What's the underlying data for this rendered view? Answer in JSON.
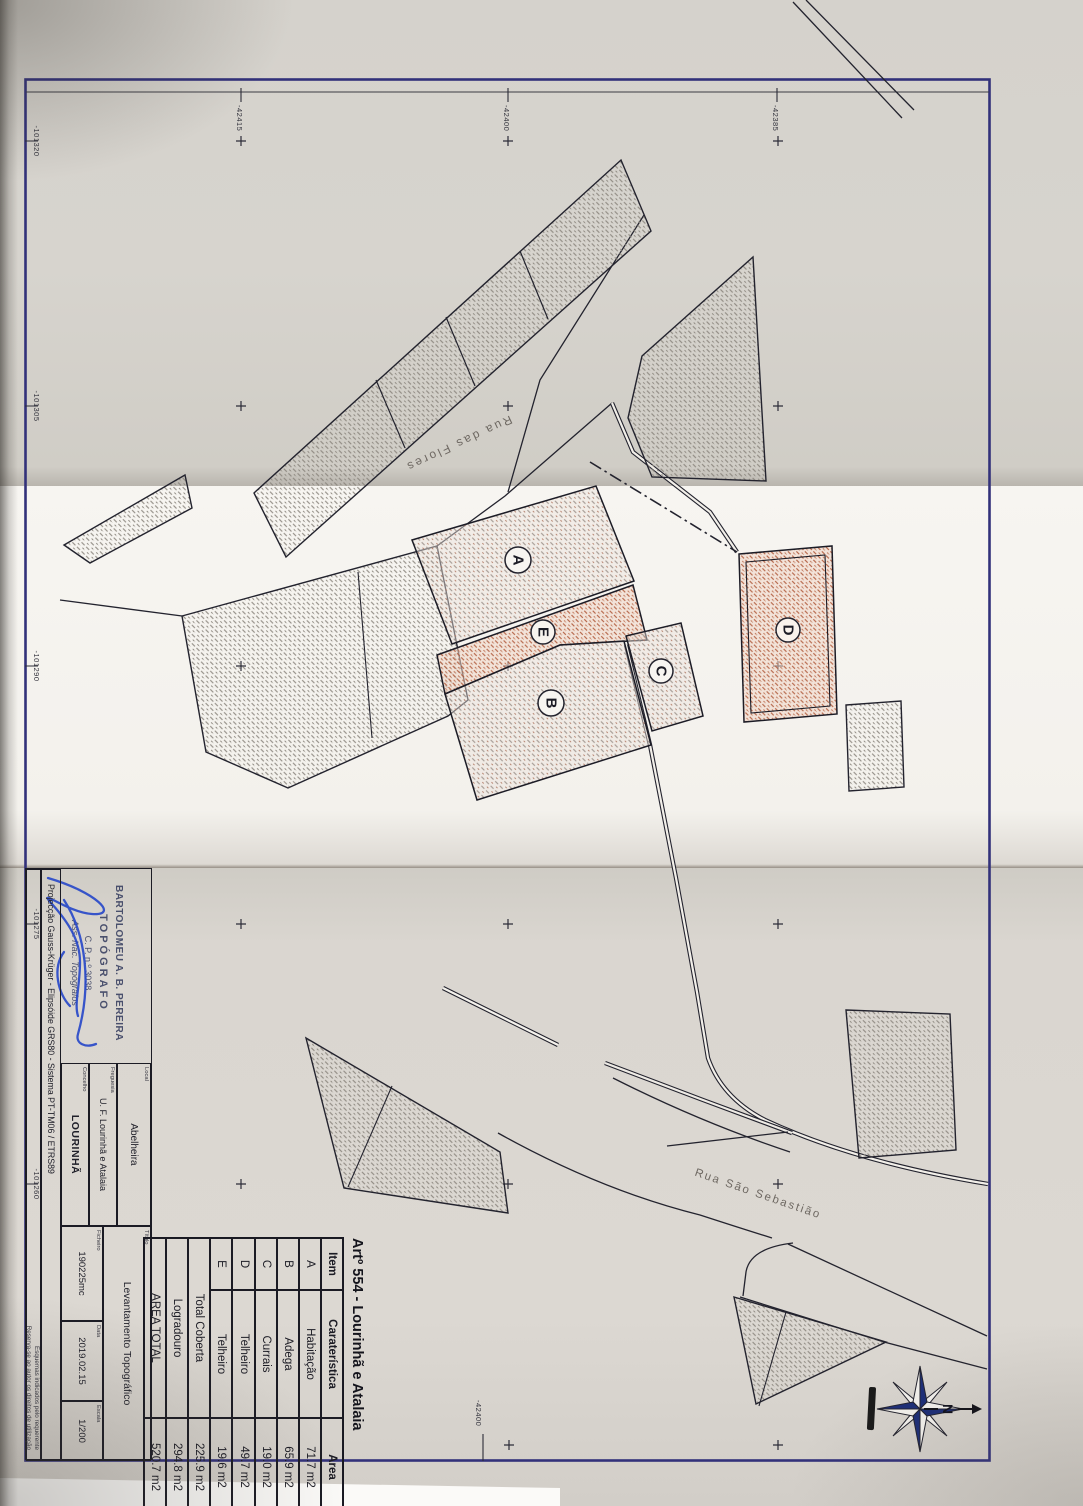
{
  "document": {
    "map_title": "Artº 554 - Lourinhã e Atalaia",
    "scale": "1/200"
  },
  "area_table": {
    "header": {
      "item": "Item",
      "carateristica": "Caraterística",
      "area": "Area"
    },
    "rows": [
      {
        "item": "A",
        "carateristica": "Habitação",
        "area": "71.7 m2"
      },
      {
        "item": "B",
        "carateristica": "Adega",
        "area": "65.9 m2"
      },
      {
        "item": "C",
        "carateristica": "Currais",
        "area": "19.0 m2"
      },
      {
        "item": "D",
        "carateristica": "Telheiro",
        "area": "49.7 m2"
      },
      {
        "item": "E",
        "carateristica": "Telheiro",
        "area": "19.6 m2"
      }
    ],
    "summary": [
      {
        "label": "Total Coberta",
        "area": "225.9 m2"
      },
      {
        "label": "Logradouro",
        "area": "294.8 m2"
      },
      {
        "label": "AREA TOTAL",
        "area": "520.7 m2"
      }
    ]
  },
  "title_block": {
    "local_label": "Local",
    "local": "Abelheira",
    "freguesia_label": "Freguesia",
    "freguesia": "U. F. Lourinhã e Atalaia",
    "concelho_label": "Concelho",
    "concelho": "LOURINHÃ",
    "titulo_label": "Título",
    "titulo": "Levantamento Topográfico",
    "ficheiro_label": "Ficheiro",
    "ficheiro": "190225mc",
    "data_label": "Data",
    "data": "2019.02.15",
    "escala_label": "Escala",
    "escala": "1/200",
    "projeccao": "Projecção Gauss-Krüger - Elipsóide GRS80 - Sistema PT-TM06 / ETRS89",
    "nota1": "Esquemas indicados pelo requerente",
    "nota2": "Reserva-se ao autor os direitos de utilização"
  },
  "stamp": {
    "line1": "BARTOLOMEU A. B. PEREIRA",
    "line2": "TOPÓGRAFO",
    "line3": "C. P. n.º 3038",
    "line4": "Ass. Nac. Topógrafos"
  },
  "streets": {
    "flores": "Rua das Flores",
    "sebastiao": "Rua São Sebastião"
  },
  "buildings": {
    "a": "A",
    "b": "B",
    "c": "C",
    "d": "D",
    "e": "E"
  },
  "grid": {
    "top": [
      "-42415",
      "-42400",
      "-42385"
    ],
    "left": [
      "-101320",
      "-101305",
      "-101290",
      "-101275",
      "-101260"
    ],
    "bottom": [
      "-42400"
    ]
  },
  "compass": {
    "north": "N"
  },
  "colors": {
    "frame": "#32317a",
    "ink": "#23232e",
    "hatch_gray": "#87827a",
    "hatch_pink": "#9a8f88",
    "hatch_red": "#ad5434",
    "signature": "#2647c9",
    "compass_navy": "#1d2e78"
  }
}
